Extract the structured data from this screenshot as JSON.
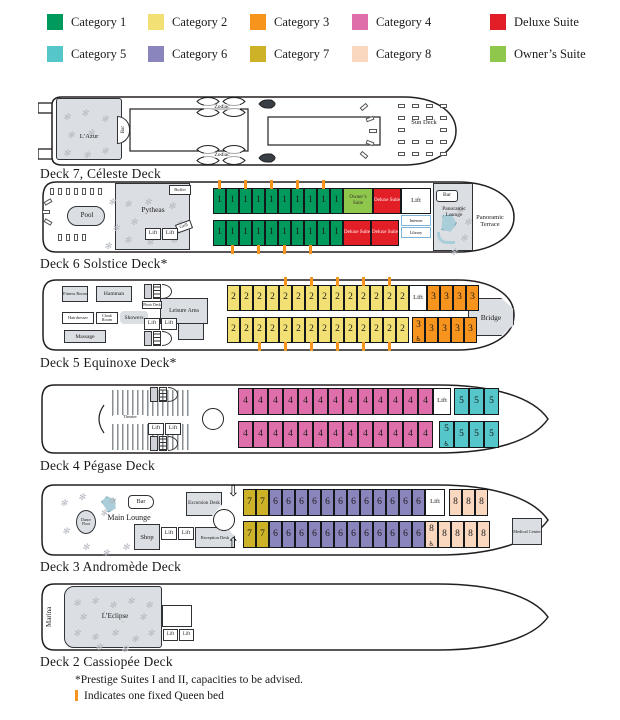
{
  "colors": {
    "cat1": "#009B5C",
    "cat2": "#F3E074",
    "cat3": "#F7941E",
    "cat4": "#DF6FAB",
    "cat5": "#55C6CA",
    "cat6": "#8B85BE",
    "cat7": "#CDB227",
    "cat8": "#FAD7BF",
    "deluxe": "#E21E26",
    "owner": "#8FC64C",
    "lift": "#FFFFFF",
    "queen_mark": "#F7941E"
  },
  "legend": {
    "items": [
      {
        "label": "Category 1",
        "color_key": "cat1",
        "row": 1
      },
      {
        "label": "Category 2",
        "color_key": "cat2",
        "row": 1
      },
      {
        "label": "Category 3",
        "color_key": "cat3",
        "row": 1
      },
      {
        "label": "Category 4",
        "color_key": "cat4",
        "row": 1
      },
      {
        "label": "Deluxe Suite",
        "color_key": "deluxe",
        "row": 1
      },
      {
        "label": "Category 5",
        "color_key": "cat5",
        "row": 2
      },
      {
        "label": "Category 6",
        "color_key": "cat6",
        "row": 2
      },
      {
        "label": "Category 7",
        "color_key": "cat7",
        "row": 2
      },
      {
        "label": "Category 8",
        "color_key": "cat8",
        "row": 2
      },
      {
        "label": "Owner’s Suite",
        "color_key": "owner",
        "row": 2
      }
    ]
  },
  "decks": {
    "deck7": {
      "label": "Deck 7, Céleste Deck",
      "rooms": {
        "lazur": "L’Azur",
        "bar": "Bar",
        "zodiac": "Zodiac",
        "sun_deck": "Sun Deck"
      }
    },
    "deck6": {
      "label": "Deck 6 Solstice Deck*",
      "rooms": {
        "pool": "Pool",
        "restaurant": "Pytheas",
        "buffet": "Buffet",
        "grill": "Grill",
        "lift": "Lift",
        "bar": "Bar",
        "internet": "Internet",
        "library": "Library",
        "lounge": "Panoramic Lounge",
        "terrace": "Panoramic Terrace"
      },
      "cabins_top": [
        {
          "n": "1",
          "cat": "cat1",
          "queen": true
        },
        {
          "n": "1",
          "cat": "cat1"
        },
        {
          "n": "1",
          "cat": "cat1",
          "queen": true
        },
        {
          "n": "1",
          "cat": "cat1"
        },
        {
          "n": "1",
          "cat": "cat1",
          "queen": true
        },
        {
          "n": "1",
          "cat": "cat1"
        },
        {
          "n": "1",
          "cat": "cat1",
          "queen": true
        },
        {
          "n": "1",
          "cat": "cat1"
        },
        {
          "n": "1",
          "cat": "cat1",
          "queen": true
        },
        {
          "n": "1",
          "cat": "cat1"
        },
        {
          "n": "Owner’s Suite",
          "cat": "owner",
          "type": "suite2"
        },
        {
          "n": "Deluxe Suite",
          "cat": "deluxe",
          "type": "suite"
        },
        {
          "n": "Lift",
          "cat": "lift",
          "type": "lift"
        }
      ],
      "cabins_bottom": [
        {
          "n": "1",
          "cat": "cat1"
        },
        {
          "n": "1",
          "cat": "cat1",
          "queen": true
        },
        {
          "n": "1",
          "cat": "cat1"
        },
        {
          "n": "1",
          "cat": "cat1",
          "queen": true
        },
        {
          "n": "1",
          "cat": "cat1"
        },
        {
          "n": "1",
          "cat": "cat1",
          "queen": true
        },
        {
          "n": "1",
          "cat": "cat1"
        },
        {
          "n": "1",
          "cat": "cat1",
          "queen": true
        },
        {
          "n": "1",
          "cat": "cat1"
        },
        {
          "n": "1",
          "cat": "cat1"
        },
        {
          "n": "Deluxe Suite",
          "cat": "deluxe",
          "type": "suite"
        },
        {
          "n": "Deluxe Suite",
          "cat": "deluxe",
          "type": "suite"
        }
      ]
    },
    "deck5": {
      "label": "Deck 5 Equinoxe Deck*",
      "rooms": {
        "fitness": "Fitness Room",
        "hammam": "Hamman",
        "hairdresser": "Hairdresser",
        "cloak": "Cloak Room",
        "showers": "Showers",
        "massage": "Massage",
        "photo": "Photo Desk",
        "leisure": "Leisure Area",
        "lift": "Lift",
        "bridge": "Bridge"
      },
      "cabins_top": [
        {
          "n": "2",
          "cat": "cat2"
        },
        {
          "n": "2",
          "cat": "cat2"
        },
        {
          "n": "2",
          "cat": "cat2"
        },
        {
          "n": "2",
          "cat": "cat2"
        },
        {
          "n": "2",
          "cat": "cat2",
          "queen": true
        },
        {
          "n": "2",
          "cat": "cat2"
        },
        {
          "n": "2",
          "cat": "cat2",
          "queen": true
        },
        {
          "n": "2",
          "cat": "cat2"
        },
        {
          "n": "2",
          "cat": "cat2",
          "queen": true
        },
        {
          "n": "2",
          "cat": "cat2"
        },
        {
          "n": "2",
          "cat": "cat2",
          "queen": true
        },
        {
          "n": "2",
          "cat": "cat2"
        },
        {
          "n": "2",
          "cat": "cat2",
          "queen": true
        },
        {
          "n": "2",
          "cat": "cat2"
        },
        {
          "n": "Lift",
          "cat": "lift",
          "type": "lift"
        },
        {
          "n": "3",
          "cat": "cat3"
        },
        {
          "n": "3",
          "cat": "cat3"
        },
        {
          "n": "3",
          "cat": "cat3"
        },
        {
          "n": "3",
          "cat": "cat3"
        }
      ],
      "cabins_bottom": [
        {
          "n": "2",
          "cat": "cat2"
        },
        {
          "n": "2",
          "cat": "cat2"
        },
        {
          "n": "2",
          "cat": "cat2",
          "queen": true
        },
        {
          "n": "2",
          "cat": "cat2"
        },
        {
          "n": "2",
          "cat": "cat2",
          "queen": true
        },
        {
          "n": "2",
          "cat": "cat2"
        },
        {
          "n": "2",
          "cat": "cat2",
          "queen": true
        },
        {
          "n": "2",
          "cat": "cat2"
        },
        {
          "n": "2",
          "cat": "cat2",
          "queen": true
        },
        {
          "n": "2",
          "cat": "cat2"
        },
        {
          "n": "2",
          "cat": "cat2",
          "queen": true
        },
        {
          "n": "2",
          "cat": "cat2"
        },
        {
          "n": "2",
          "cat": "cat2",
          "queen": true
        },
        {
          "n": "2",
          "cat": "cat2"
        },
        {
          "type": "gap",
          "w": 3
        },
        {
          "n": "3",
          "cat": "cat3",
          "accessible": true
        },
        {
          "n": "3",
          "cat": "cat3"
        },
        {
          "n": "3",
          "cat": "cat3"
        },
        {
          "n": "3",
          "cat": "cat3"
        },
        {
          "n": "3",
          "cat": "cat3"
        }
      ]
    },
    "deck4": {
      "label": "Deck 4 Pégase Deck",
      "rooms": {
        "theater": "Theater",
        "lift": "Lift"
      },
      "cabins_top": [
        {
          "n": "4",
          "cat": "cat4"
        },
        {
          "n": "4",
          "cat": "cat4"
        },
        {
          "n": "4",
          "cat": "cat4"
        },
        {
          "n": "4",
          "cat": "cat4"
        },
        {
          "n": "4",
          "cat": "cat4"
        },
        {
          "n": "4",
          "cat": "cat4"
        },
        {
          "n": "4",
          "cat": "cat4"
        },
        {
          "n": "4",
          "cat": "cat4"
        },
        {
          "n": "4",
          "cat": "cat4"
        },
        {
          "n": "4",
          "cat": "cat4"
        },
        {
          "n": "4",
          "cat": "cat4"
        },
        {
          "n": "4",
          "cat": "cat4"
        },
        {
          "n": "4",
          "cat": "cat4"
        },
        {
          "n": "Lift",
          "cat": "lift",
          "type": "lift"
        },
        {
          "type": "gap",
          "w": 3
        },
        {
          "n": "5",
          "cat": "cat5"
        },
        {
          "n": "5",
          "cat": "cat5"
        },
        {
          "n": "5",
          "cat": "cat5"
        }
      ],
      "cabins_bottom": [
        {
          "n": "4",
          "cat": "cat4"
        },
        {
          "n": "4",
          "cat": "cat4"
        },
        {
          "n": "4",
          "cat": "cat4"
        },
        {
          "n": "4",
          "cat": "cat4"
        },
        {
          "n": "4",
          "cat": "cat4"
        },
        {
          "n": "4",
          "cat": "cat4"
        },
        {
          "n": "4",
          "cat": "cat4"
        },
        {
          "n": "4",
          "cat": "cat4"
        },
        {
          "n": "4",
          "cat": "cat4"
        },
        {
          "n": "4",
          "cat": "cat4"
        },
        {
          "n": "4",
          "cat": "cat4"
        },
        {
          "n": "4",
          "cat": "cat4"
        },
        {
          "n": "4",
          "cat": "cat4"
        },
        {
          "type": "gap",
          "w": 6
        },
        {
          "n": "5",
          "cat": "cat5",
          "accessible": true
        },
        {
          "n": "5",
          "cat": "cat5"
        },
        {
          "n": "5",
          "cat": "cat5"
        },
        {
          "n": "5",
          "cat": "cat5"
        }
      ]
    },
    "deck3": {
      "label": "Deck 3 Andromède Deck",
      "rooms": {
        "dance": "Dance Floor",
        "main_lounge": "Main Lounge",
        "bar": "Bar",
        "excursion": "Excursion Desk",
        "shop": "Shop",
        "lift": "Lift",
        "reception": "Reception Desk",
        "medical": "Medical Center"
      },
      "cabins_top": [
        {
          "n": "7",
          "cat": "cat7"
        },
        {
          "n": "7",
          "cat": "cat7"
        },
        {
          "n": "6",
          "cat": "cat6"
        },
        {
          "n": "6",
          "cat": "cat6"
        },
        {
          "n": "6",
          "cat": "cat6"
        },
        {
          "n": "6",
          "cat": "cat6"
        },
        {
          "n": "6",
          "cat": "cat6"
        },
        {
          "n": "6",
          "cat": "cat6"
        },
        {
          "n": "6",
          "cat": "cat6"
        },
        {
          "n": "6",
          "cat": "cat6"
        },
        {
          "n": "6",
          "cat": "cat6"
        },
        {
          "n": "6",
          "cat": "cat6"
        },
        {
          "n": "6",
          "cat": "cat6"
        },
        {
          "n": "6",
          "cat": "cat6"
        },
        {
          "n": "Lift",
          "cat": "lift",
          "type": "lift"
        },
        {
          "type": "gap",
          "w": 4
        },
        {
          "n": "8",
          "cat": "cat8"
        },
        {
          "n": "8",
          "cat": "cat8"
        },
        {
          "n": "8",
          "cat": "cat8"
        }
      ],
      "cabins_bottom": [
        {
          "n": "7",
          "cat": "cat7"
        },
        {
          "n": "7",
          "cat": "cat7"
        },
        {
          "n": "6",
          "cat": "cat6"
        },
        {
          "n": "6",
          "cat": "cat6"
        },
        {
          "n": "6",
          "cat": "cat6"
        },
        {
          "n": "6",
          "cat": "cat6"
        },
        {
          "n": "6",
          "cat": "cat6"
        },
        {
          "n": "6",
          "cat": "cat6"
        },
        {
          "n": "6",
          "cat": "cat6"
        },
        {
          "n": "6",
          "cat": "cat6"
        },
        {
          "n": "6",
          "cat": "cat6"
        },
        {
          "n": "6",
          "cat": "cat6"
        },
        {
          "n": "6",
          "cat": "cat6"
        },
        {
          "n": "6",
          "cat": "cat6"
        },
        {
          "n": "8",
          "cat": "cat8",
          "accessible": true
        },
        {
          "n": "8",
          "cat": "cat8"
        },
        {
          "n": "8",
          "cat": "cat8"
        },
        {
          "n": "8",
          "cat": "cat8"
        },
        {
          "n": "8",
          "cat": "cat8"
        }
      ]
    },
    "deck2": {
      "label": "Deck 2 Cassiopée Deck",
      "rooms": {
        "marina": "Marina",
        "restaurant": "L’Eclipse",
        "lift": "Lift"
      }
    }
  },
  "footnotes": {
    "prestige": "*Prestige Suites I and II, capacities to be advised.",
    "queen": "Indicates one fixed Queen bed"
  }
}
